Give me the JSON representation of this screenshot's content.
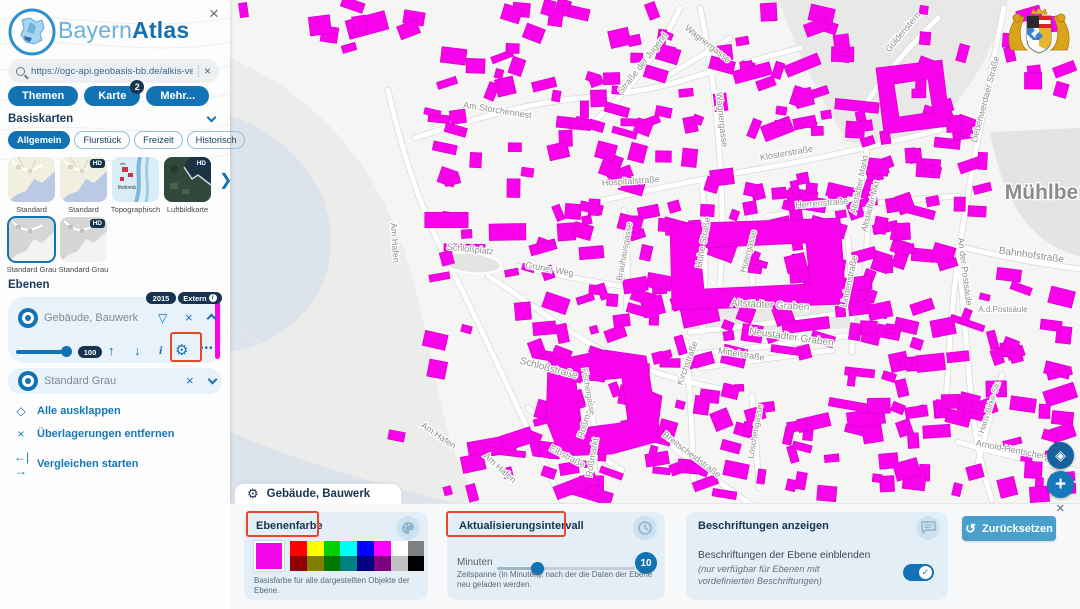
{
  "app": {
    "title_light": "Bayern",
    "title_bold": "Atlas"
  },
  "icons": {
    "close": "×",
    "filter": "▽",
    "arrow_up": "↑",
    "arrow_down": "↓",
    "info": "i",
    "gear": "⚙",
    "more_dots": "•••",
    "expand": "◇",
    "compare": "←|→",
    "reset": "↺",
    "geolocate": "◈",
    "plus": "+",
    "next": "❯",
    "check": "✓"
  },
  "sidebar": {
    "search": {
      "value": "https://ogc-api.geobasis-bb.de/alkis-verein"
    },
    "menu_buttons": [
      {
        "label": "Themen",
        "badge": null
      },
      {
        "label": "Karte",
        "badge": "2"
      },
      {
        "label": "Mehr...",
        "badge": null
      }
    ],
    "basemaps": {
      "title": "Basiskarten",
      "tabs": [
        {
          "label": "Allgemein",
          "active": true
        },
        {
          "label": "Flurstück",
          "active": false
        },
        {
          "label": "Freizeit",
          "active": false
        },
        {
          "label": "Historisch",
          "active": false
        }
      ],
      "hd_badge": "HD",
      "thumbs": [
        {
          "label": "Standard",
          "variant": "standard",
          "hd": false,
          "selected": false
        },
        {
          "label": "Standard",
          "variant": "standard",
          "hd": true,
          "selected": false
        },
        {
          "label": "Topographisch",
          "variant": "topo",
          "hd": false,
          "selected": false
        },
        {
          "label": "Luftbildkarte",
          "variant": "aerial",
          "hd": true,
          "selected": false
        },
        {
          "label": "Standard Grau",
          "variant": "gray",
          "hd": false,
          "selected": true
        },
        {
          "label": "Standard Grau",
          "variant": "gray",
          "hd": true,
          "selected": false
        }
      ]
    },
    "layers": {
      "title": "Ebenen",
      "layer1": {
        "name": "Gebäude, Bauwerk",
        "badge_year": "2015",
        "badge_source": "Extern",
        "opacity": "100",
        "color": "#f505ea"
      },
      "layer2": {
        "name": "Standard Grau"
      },
      "links": [
        {
          "label": "Alle ausklappen"
        },
        {
          "label": "Überlagerungen entfernen"
        },
        {
          "label": "Vergleichen starten"
        }
      ]
    }
  },
  "panel": {
    "tab_title": "Gebäude, Bauwerk",
    "reset_label": "Zurücksetzen",
    "cards": {
      "color": {
        "title": "Ebenenfarbe",
        "selected_color": "#f505ea",
        "palette_row1": [
          "#ff0000",
          "#ffff00",
          "#00d000",
          "#00ffff",
          "#0000ff",
          "#ff00ff",
          "#ffffff",
          "#808080"
        ],
        "palette_row2": [
          "#900000",
          "#808000",
          "#007800",
          "#008080",
          "#000080",
          "#800080",
          "#c0c0c0",
          "#000000"
        ],
        "caption": "Basisfarbe für alle dargestellten Objekte der Ebene."
      },
      "interval": {
        "title": "Aktualisierungsintervall",
        "unit_label": "Minuten",
        "value": "10",
        "caption": "Zeitspanne (in Minuten), nach der die Daten der Ebene neu geladen werden."
      },
      "labels": {
        "title": "Beschriftungen anzeigen",
        "line1": "Beschriftungen der Ebene einblenden",
        "line2": "(nur verfügbar für Ebenen mit vordefinierten Beschriftungen)",
        "toggle_on": true
      }
    }
  },
  "annotation_color": "#e8472b",
  "map": {
    "place_label": {
      "text": "Mühlberg",
      "x": 1052,
      "y": 199
    },
    "building_color": "#f802ec",
    "building_stroke": "#d800cc",
    "water_color": "#dde3ea",
    "shore_color": "#ececea",
    "water": [
      "M230,115 C268,128 305,158 322,196 C338,236 332,278 308,308 C288,332 262,346 230,352 Z",
      "M230,432 C300,462 372,482 442,500 C488,512 520,530 540,560 L545,609 L230,609 Z"
    ],
    "shore": "M230,58 C298,88 352,135 390,215 C418,275 428,350 446,425 C458,472 478,505 502,525 L230,525 Z",
    "areas": [
      {
        "d": "M762,0 L1008,0 C996,42 976,82 950,110 C922,140 882,152 848,142 C824,105 792,42 782,8 Z",
        "fill": "#e8e8e6"
      },
      {
        "d": "M990,132 C998,175 1012,214 1042,238 C1056,249 1070,254 1080,256 L1080,128 Z",
        "fill": "#e4e4e2"
      },
      {
        "d": "M692,302 L855,294 L860,328 L688,334 Z",
        "fill": "#e9e9e7"
      }
    ],
    "plaza": {
      "cx": 471,
      "cy": 263,
      "rx": 30,
      "ry": 10,
      "rot": 6,
      "fill": "#e4e4e2"
    },
    "roads": [
      "M388,90 C402,150 418,205 448,262 C478,320 520,415 562,500",
      "M415,138 C470,120 525,104 572,99 C625,93 655,90 690,78",
      "M598,118 C628,92 658,55 680,8",
      "M660,80 C690,62 712,50 730,38",
      "M700,8 C712,60 718,120 721,180 C723,215 722,250 720,285",
      "M572,207 C640,192 705,178 765,168 C825,158 885,143 940,130",
      "M768,216 C830,207 900,200 958,196",
      "M846,138 C868,95 898,57 938,18",
      "M690,78 C724,68 762,58 800,48",
      "M1004,8 C988,85 972,165 960,245 C952,300 948,355 946,410",
      "M702,182 C706,235 706,290 702,332",
      "M690,332 C750,326 812,318 862,310",
      "M668,357 C732,350 800,343 868,333",
      "M700,368 C742,362 788,356 832,350",
      "M962,247 C1002,257 1042,264 1080,269",
      "M958,247 C962,295 966,340 970,385 C973,425 980,465 992,500",
      "M488,276 C525,298 572,338 622,360 C660,376 700,386 740,392",
      "M686,342 C690,385 692,435 694,485",
      "M640,420 C678,452 718,482 756,508",
      "M588,388 C594,428 600,465 606,502",
      "M866,142 C869,200 868,258 862,312",
      "M958,442 C1000,454 1042,464 1080,471",
      "M1002,375 C992,410 983,442 976,472",
      "M752,396 C755,428 757,458 759,488",
      "M518,266 C558,276 600,283 642,289",
      "M848,238 C852,278 853,316 852,352",
      "M528,408 C560,432 592,452 622,470",
      "M748,205 C752,240 753,272 752,300",
      "M624,210 C628,245 628,278 626,308"
    ],
    "special_buildings": [
      {
        "outer": "M548,362 L604,350 L646,356 L652,392 L662,396 L656,442 L612,454 L560,456 L546,420 Z",
        "hole": "M576,382 L622,378 L628,422 L582,428 Z"
      },
      {
        "outer": "M876,68 L942,60 L950,126 L884,134 Z",
        "hole": "M894,84 L928,79 L933,112 L899,117 Z"
      },
      {
        "outer": "M670,224 L840,218 L846,304 L672,310 Z",
        "hole": "M700,248 L806,243 L810,284 L704,289 Z"
      }
    ],
    "building_zones": [
      {
        "x": 500,
        "y": 4,
        "w": 570,
        "h": 112,
        "n": 70
      },
      {
        "x": 540,
        "y": 116,
        "w": 530,
        "h": 185,
        "n": 170
      },
      {
        "x": 530,
        "y": 300,
        "w": 540,
        "h": 196,
        "n": 170
      },
      {
        "x": 395,
        "y": 150,
        "w": 135,
        "h": 345,
        "n": 26
      },
      {
        "x": 425,
        "y": 55,
        "w": 95,
        "h": 95,
        "n": 12
      },
      {
        "x": 238,
        "y": 0,
        "w": 180,
        "h": 48,
        "n": 9
      }
    ],
    "street_labels": [
      [
        "Am Storchennest",
        497,
        113,
        9,
        9
      ],
      [
        "Straße der Jugend",
        645,
        65,
        -52,
        9
      ],
      [
        "Wagnergasse",
        706,
        46,
        38,
        9
      ],
      [
        "Wagnergasse",
        719,
        120,
        84,
        9
      ],
      [
        "Güldenstern",
        905,
        34,
        -50,
        9
      ],
      [
        "Liebenwerdaer Straße",
        988,
        100,
        -75,
        9
      ],
      [
        "Am Hafen",
        392,
        243,
        86,
        9
      ],
      [
        "Am Hafen",
        437,
        438,
        34,
        9
      ],
      [
        "Am Hafen",
        498,
        470,
        42,
        9
      ],
      [
        "Schloßplatz",
        470,
        252,
        6,
        9
      ],
      [
        "Grüner Weg",
        549,
        272,
        10,
        9
      ],
      [
        "Hospitalstraße",
        631,
        184,
        -4,
        9
      ],
      [
        "Klosterstraße",
        787,
        156,
        -10,
        9
      ],
      [
        "Herrenstraße",
        822,
        206,
        -5,
        9
      ],
      [
        "Hohe Straße",
        706,
        243,
        -80,
        9
      ],
      [
        "Hütergasse",
        751,
        252,
        -75,
        8.5
      ],
      [
        "Brauhausgasse",
        627,
        252,
        -80,
        8.5
      ],
      [
        "Lindenstraße",
        852,
        282,
        -78,
        9
      ],
      [
        "Altstädter Markt",
        862,
        185,
        -78,
        8.5
      ],
      [
        "Altstädter Mkt",
        873,
        207,
        -75,
        8.5
      ],
      [
        "Altstädter Graben",
        770,
        308,
        3,
        10
      ],
      [
        "Neustädter Graben",
        791,
        340,
        8,
        10
      ],
      [
        "Mittelstraße",
        741,
        357,
        9,
        9
      ],
      [
        "Bahnhofstraße",
        1031,
        258,
        8,
        10
      ],
      [
        "An der Postsäule",
        962,
        272,
        83,
        9
      ],
      [
        "A.d.Postsäule",
        1003,
        312,
        0,
        8
      ],
      [
        "Schloßstraße",
        548,
        371,
        15,
        10
      ],
      [
        "Roßmarkt",
        589,
        420,
        -72,
        9
      ],
      [
        "Roßmarkt",
        595,
        458,
        -80,
        9
      ],
      [
        "Elbstraße",
        566,
        459,
        28,
        9
      ],
      [
        "Breitscheidstraße",
        690,
        457,
        37,
        9
      ],
      [
        "Löschengasse",
        758,
        432,
        -80,
        8.5
      ],
      [
        "Kirchstraße",
        690,
        364,
        -70,
        9
      ],
      [
        "Fischergasse",
        586,
        392,
        80,
        8
      ],
      [
        "Hans-Birke-Str.",
        992,
        408,
        -72,
        8
      ],
      [
        "Arnold-Hentschel-Straße",
        1024,
        455,
        11,
        9
      ]
    ]
  }
}
